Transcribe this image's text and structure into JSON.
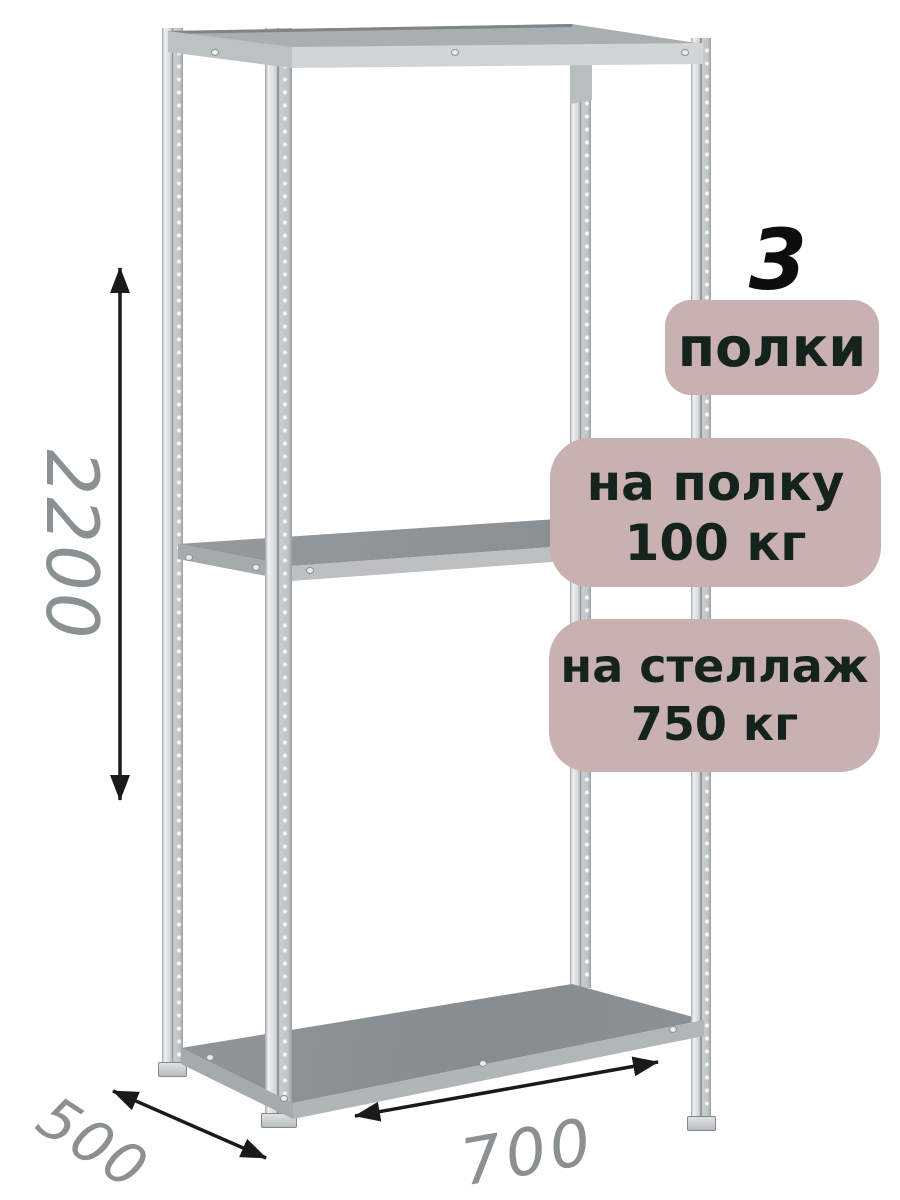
{
  "annotations": {
    "shelf_count": "3",
    "shelf_count_label": "полки",
    "per_shelf_capacity": {
      "line1": "на полку",
      "line2": "100 кг"
    },
    "per_rack_capacity": {
      "line1": "на стеллаж",
      "line2": "750 кг"
    }
  },
  "dimensions": {
    "height": "2200",
    "depth": "500",
    "width": "700"
  },
  "icons": {
    "height_arrow": "double-headed-vertical-arrow",
    "width_arrow": "double-headed-horizontal-arrow",
    "depth_arrow": "double-headed-diagonal-arrow"
  },
  "colors": {
    "badge_background": "#cab1b1",
    "badge_text": "#14231b",
    "count_text": "#0d0d0d",
    "dimension_text": "#8b9093",
    "arrow": "#1a1a1a",
    "background": "#ffffff",
    "shelf_surface": "#8d9396",
    "metal_light": "#d3d7d9",
    "metal_mid": "#b3b8bb"
  }
}
